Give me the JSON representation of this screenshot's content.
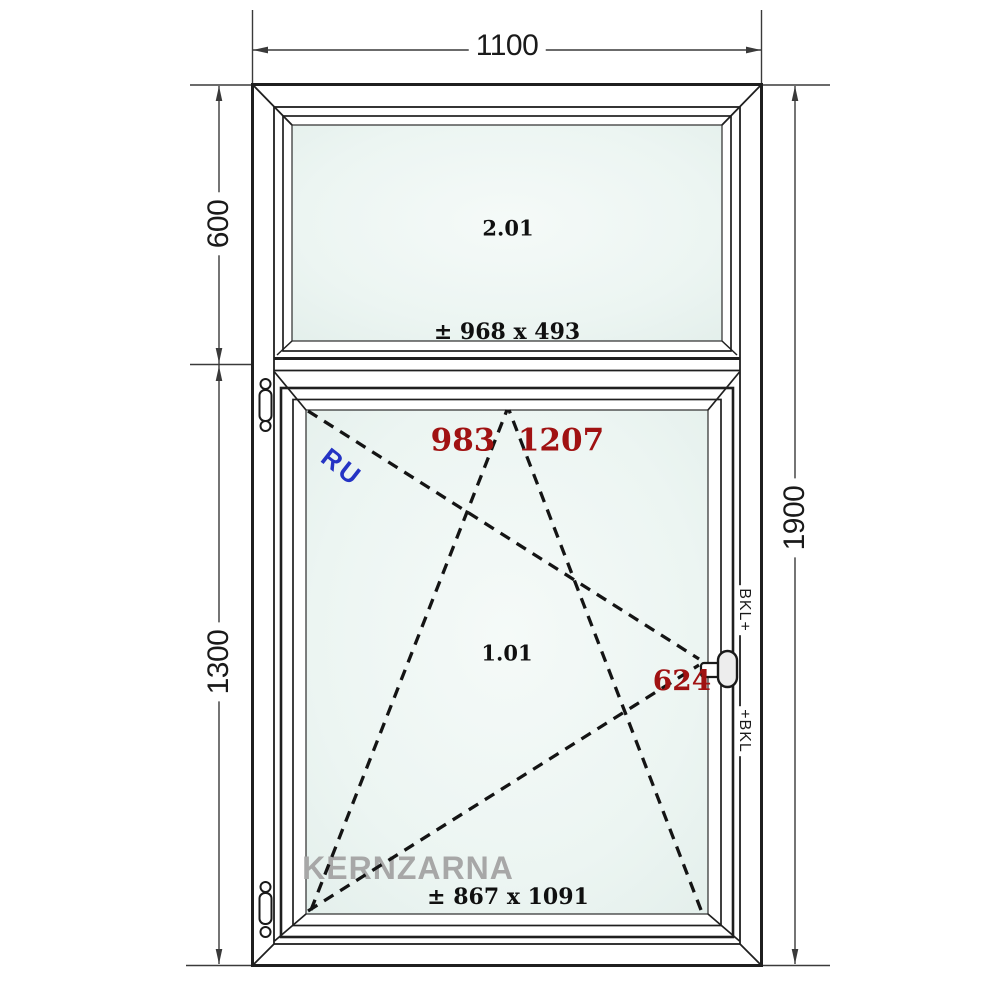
{
  "dimensions": {
    "total_width": "1100",
    "upper_section_height": "600",
    "lower_section_height": "1300",
    "total_height": "1900"
  },
  "upper_sash": {
    "label": "2.01",
    "glass_size": "± 968 x 493"
  },
  "lower_sash": {
    "label": "1.01",
    "glass_size": "± 867 x 1091",
    "sash_width": "983",
    "sash_height": "1207",
    "handle_height": "624",
    "opening_code": "RU",
    "hardware_label_top": "BKL+",
    "hardware_label_bottom": "+BKL"
  },
  "watermark": "KERNZARNA",
  "symbols": {
    "tilt_symbol": "dashed-tilt-triangle-icon",
    "turn_symbol": "dashed-turn-triangle-icon",
    "handle": "window-handle-icon",
    "hinge": "hinge-icon"
  },
  "colors": {
    "line": "#1f1f1f",
    "dimension_line": "#3a3a3a",
    "glass_center": "#f5faf8",
    "glass_edge": "#e2eeea",
    "accent_red": "#a01212",
    "accent_blue": "#2433c4",
    "watermark_gray": "#a7a7a7",
    "background": "#ffffff"
  }
}
